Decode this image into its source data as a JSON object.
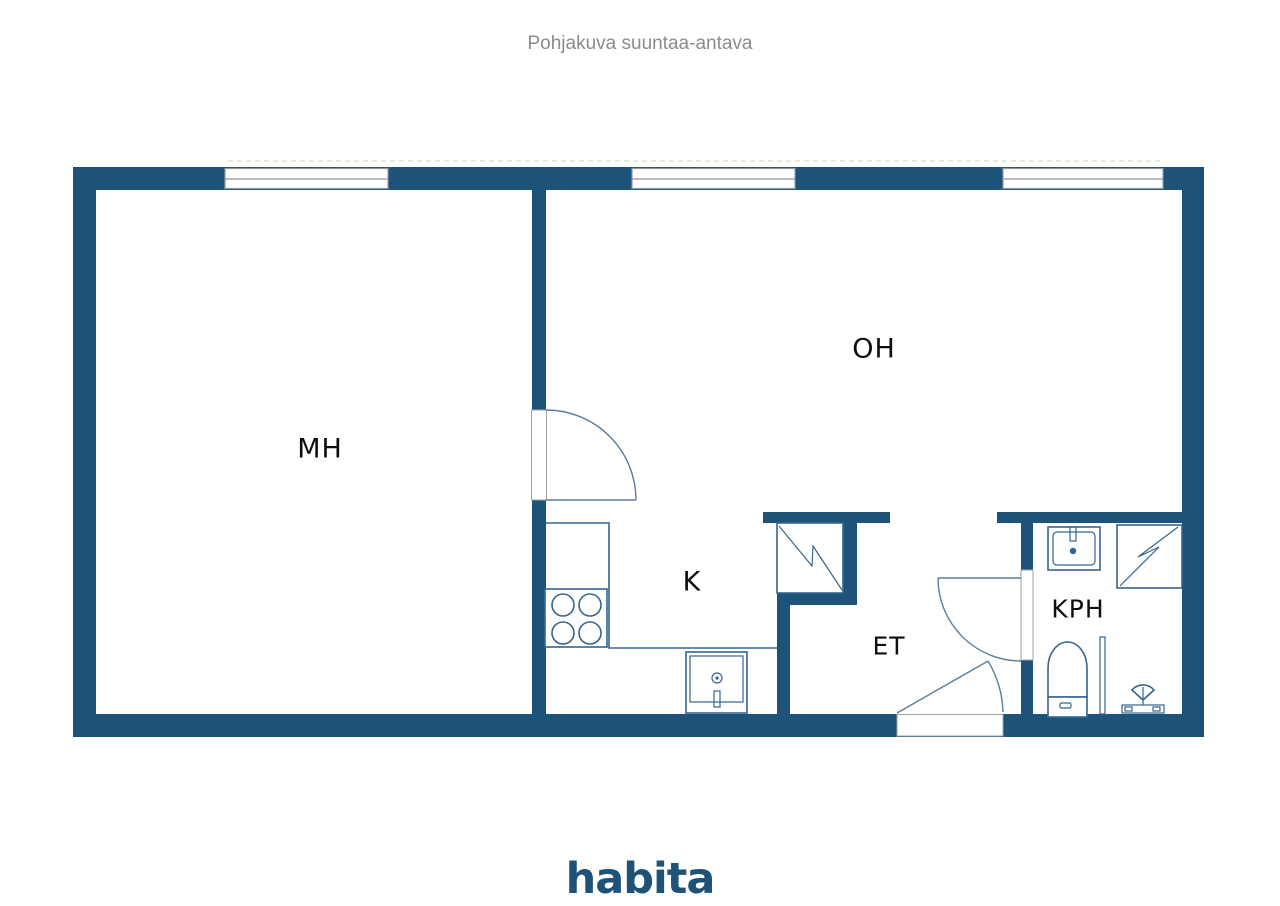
{
  "title": "Pohjakuva suuntaa-antava",
  "plan": {
    "rooms": {
      "mh": {
        "label": "MH"
      },
      "oh": {
        "label": "OH"
      },
      "k": {
        "label": "K"
      },
      "et": {
        "label": "ET"
      },
      "kph": {
        "label": "KPH"
      }
    },
    "fixtures": [
      "window",
      "window",
      "window",
      "interior-door",
      "bathroom-door",
      "entrance-door",
      "kitchen-counter",
      "stove",
      "kitchen-sink",
      "wardrobe",
      "washbasin",
      "shower",
      "shower-screen",
      "toilet",
      "shower-mixer"
    ],
    "colors": {
      "wall": "#1d5379",
      "fixture_line": "#35658f",
      "door_arc": "#5b7d9c",
      "window_frame": "#8f989f",
      "label_text": "#0e0e0e",
      "title_text": "#8b8b8b",
      "brand": "#1e5377"
    }
  },
  "footer": {
    "brand": "habita"
  }
}
